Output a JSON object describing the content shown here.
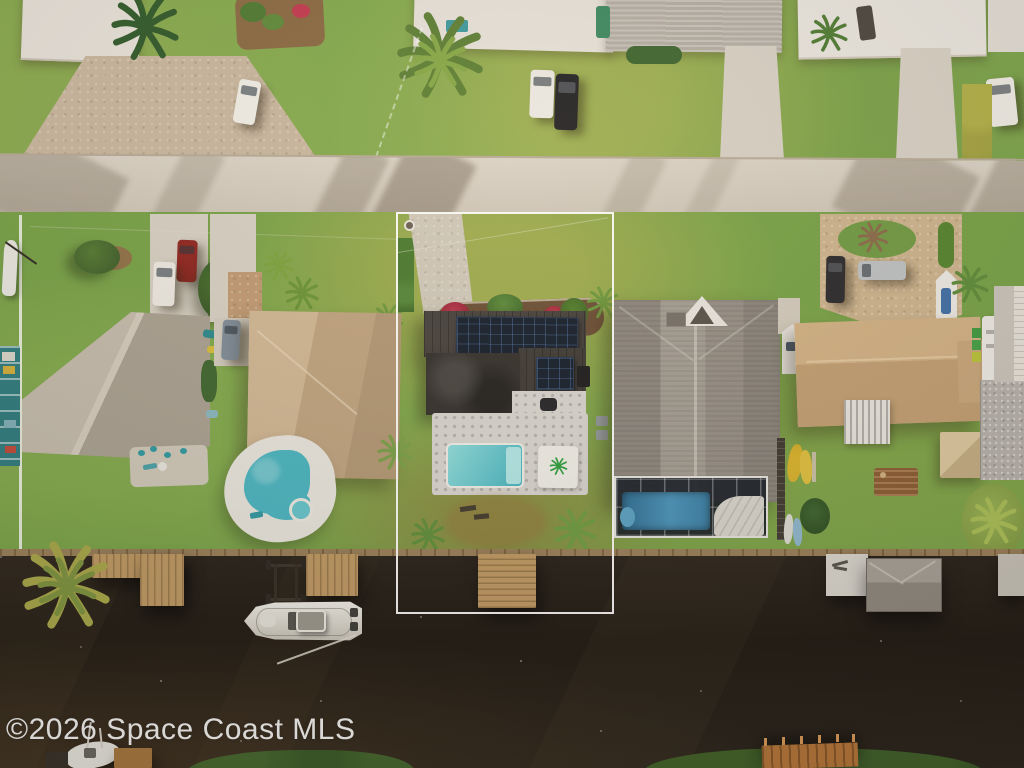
{
  "watermark": {
    "text": "©2026 Space Coast MLS",
    "color": "#ffffff"
  },
  "scene": {
    "type": "aerial-drone-photograph",
    "subject": "canal-front-home-with-white-lot-outline",
    "features": [
      "street",
      "front-yards",
      "parked-cars",
      "palm-trees",
      "outlined-property",
      "paver-driveway",
      "flower-bed",
      "charcoal-metal-roof",
      "solar-panels",
      "stone-patio",
      "swimming-pool",
      "palm-logo-pad",
      "neighbor-kidney-pool-with-spa",
      "screened-pool-enclosure",
      "tan-roof-houses",
      "kayaks",
      "rv",
      "shed",
      "canal",
      "seawall",
      "wooden-docks",
      "boat-lift",
      "moored-boat",
      "boathouse",
      "bottom-dock",
      "tree-canopies"
    ]
  },
  "palette": {
    "grass": "#74a046",
    "grass_dry": "#a8a855",
    "street": "#d5cdc0",
    "concrete": "#d6d0c4",
    "pavers_tan": "#cdb48f",
    "roof_white": "#e8e4de",
    "roof_gray": "#98928a",
    "roof_tan": "#c2a888",
    "roof_charcoal": "#46423e",
    "solar_panel": "#16202e",
    "pool_water": "#4fb8c4",
    "enclosed_pool": "#3e88b0",
    "canal_water": "#211c16",
    "dock_wood": "#bf9964",
    "flowers_red": "#ae2f44",
    "outline": "#ffffff"
  }
}
